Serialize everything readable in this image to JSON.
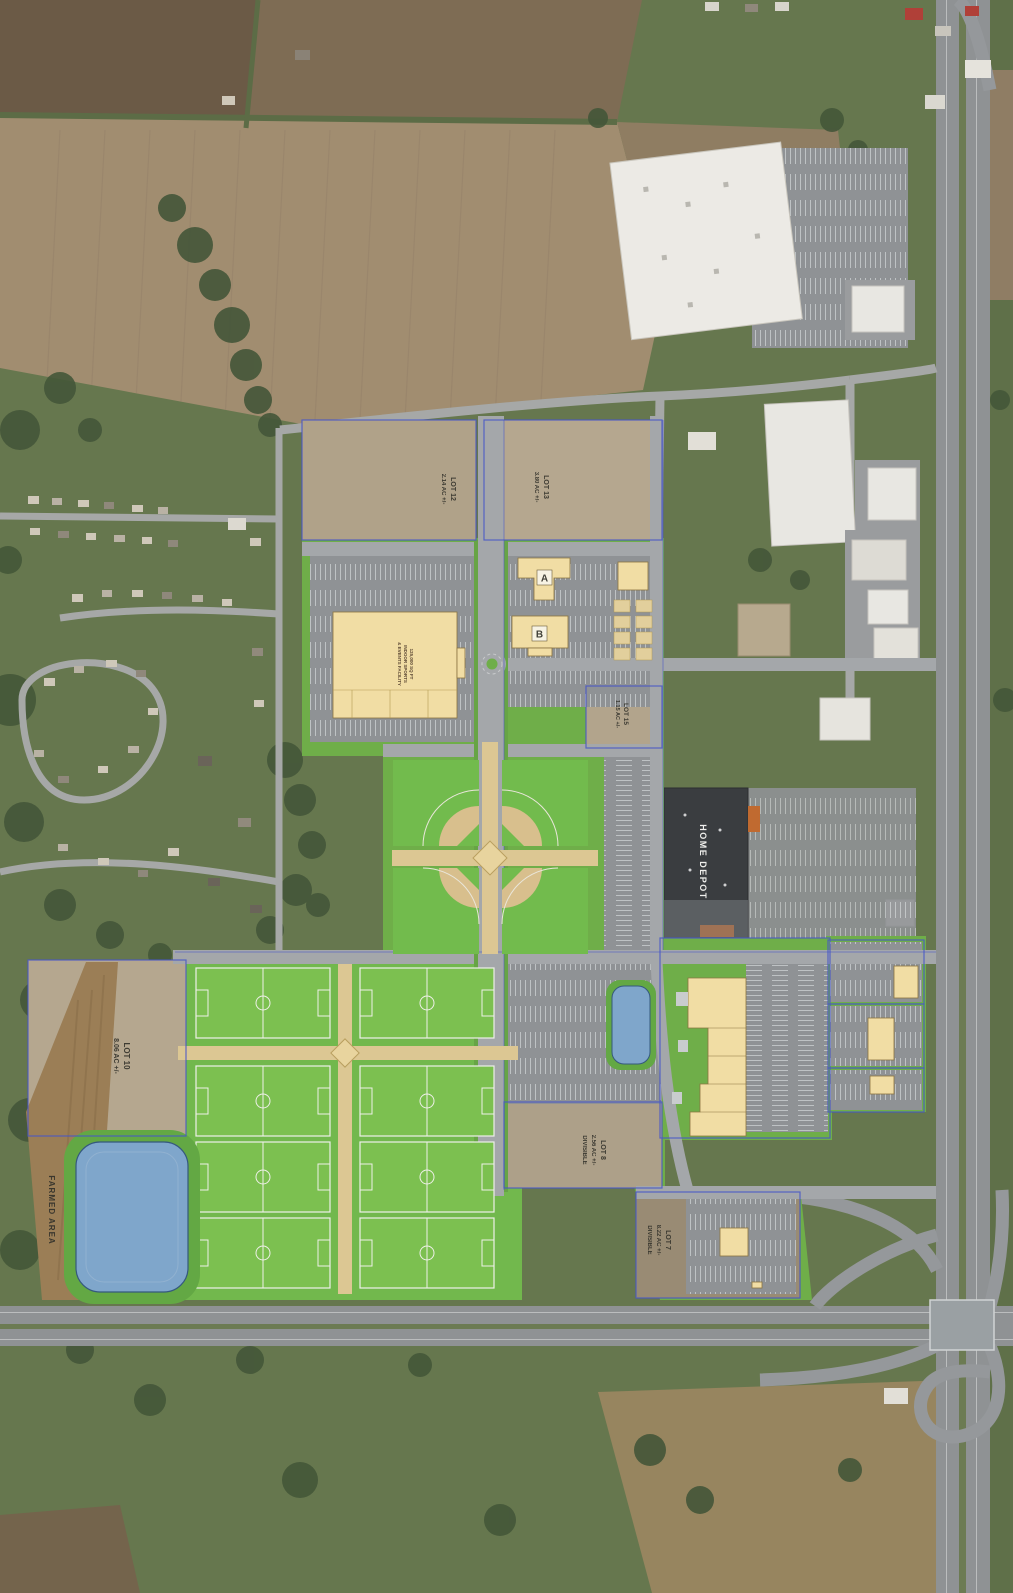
{
  "map": {
    "title": "Sports complex master plan aerial overlay",
    "lots": {
      "lot12": {
        "name": "LOT 12",
        "area": "2.14 AC +/-"
      },
      "lot13": {
        "name": "LOT 13",
        "area": "3.80 AC +/-"
      },
      "lot15": {
        "name": "LOT 15",
        "area": "1.15 AC +/-"
      },
      "lot10": {
        "name": "LOT 10",
        "area": "8.06 AC +/-"
      },
      "lot8": {
        "name": "LOT 8",
        "area": "2.56 AC +/-",
        "note": "DIVISIBLE"
      },
      "lot7": {
        "name": "LOT 7",
        "area": "8.22 AC +/-",
        "note": "DIVISIBLE"
      }
    },
    "buildings": {
      "building_a": "A",
      "building_b": "B",
      "home_depot": "HOME DEPOT",
      "sports_facility": {
        "line1": "125,000 SQ FT",
        "line2": "INDOOR SPORTS",
        "line3": "& EVENTS FACILITY"
      }
    },
    "areas": {
      "farmed": "FARMED AREA"
    },
    "colors": {
      "plan_green": "#6fae49",
      "field_green": "#7cc050",
      "parking_gray": "#8f9295",
      "road_gray": "#a4a7aa",
      "building_tan": "#f1dda4",
      "infield_tan": "#d8bf8d",
      "pond_blue": "#7fa6cb",
      "boundary_blue": "#4656c8",
      "home_depot_roof": "#3a3d40"
    }
  }
}
